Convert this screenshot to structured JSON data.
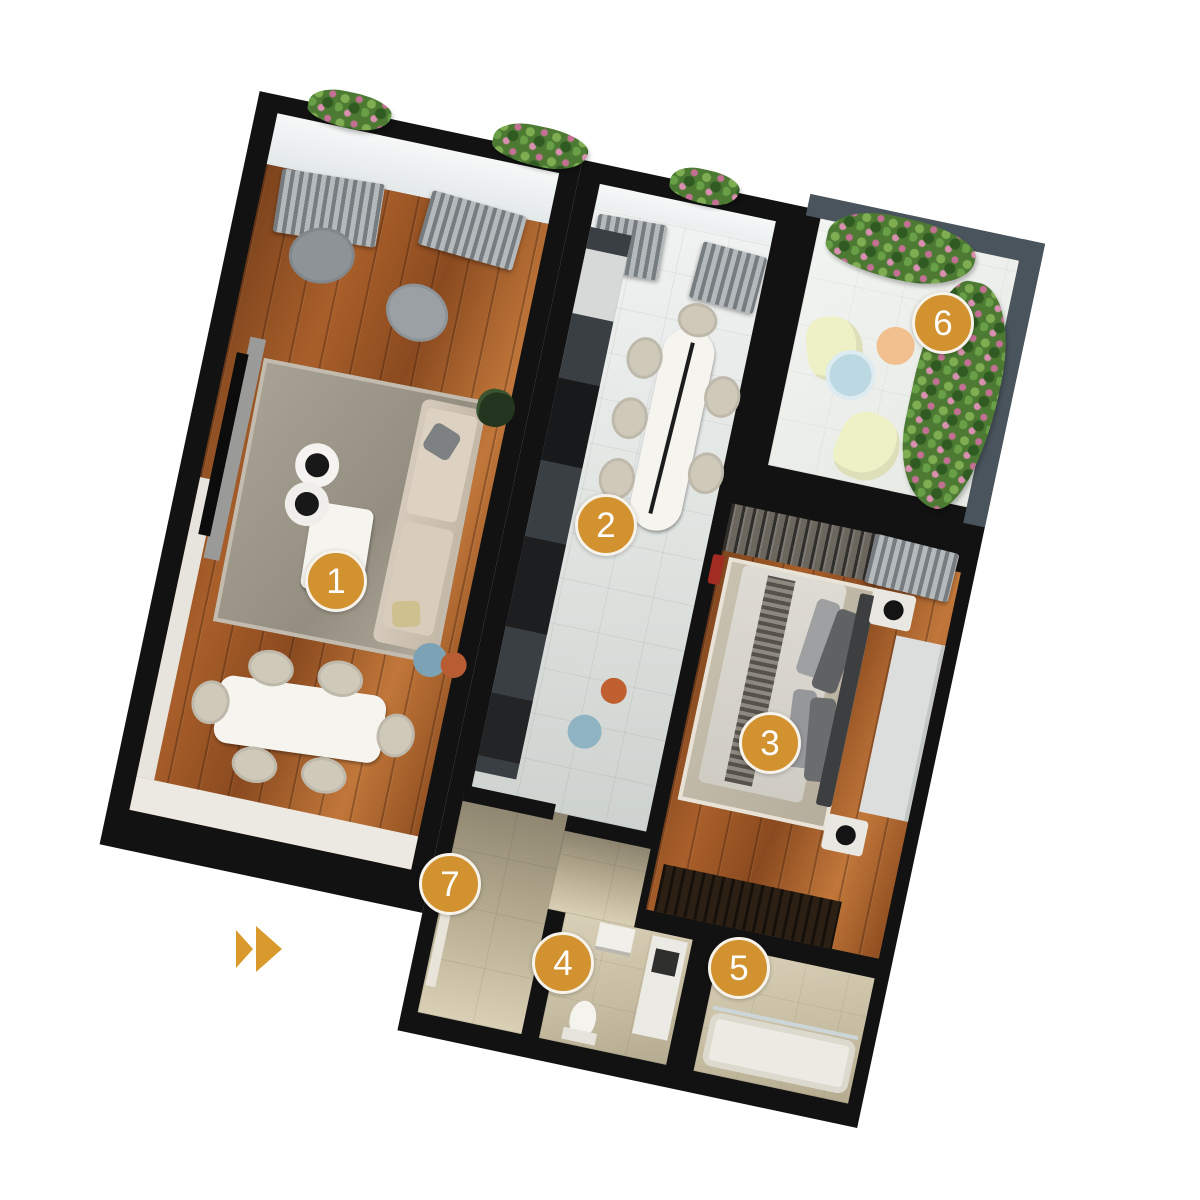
{
  "scene": {
    "type": "apartment-floorplan-3d-render",
    "background": "#FFFFFF"
  },
  "markers": [
    {
      "label": "1"
    },
    {
      "label": "2"
    },
    {
      "label": "3"
    },
    {
      "label": "4"
    },
    {
      "label": "5"
    },
    {
      "label": "6"
    },
    {
      "label": "7"
    }
  ],
  "colors": {
    "marker_fill": "#D2922F",
    "marker_ring": "#F7F3EA",
    "marker_text": "#FFFFFF",
    "chevron": "#D9992C",
    "wall": "#121212",
    "wood_floor": "#A95F2A",
    "white_tile": "#E4E8E6",
    "beige_tile": "#B2A88D",
    "balcony_hedge": "#4C7A33",
    "hedge_flower": "#D98FB0"
  },
  "icons": {
    "chevron_next": "double-right-chevron"
  }
}
